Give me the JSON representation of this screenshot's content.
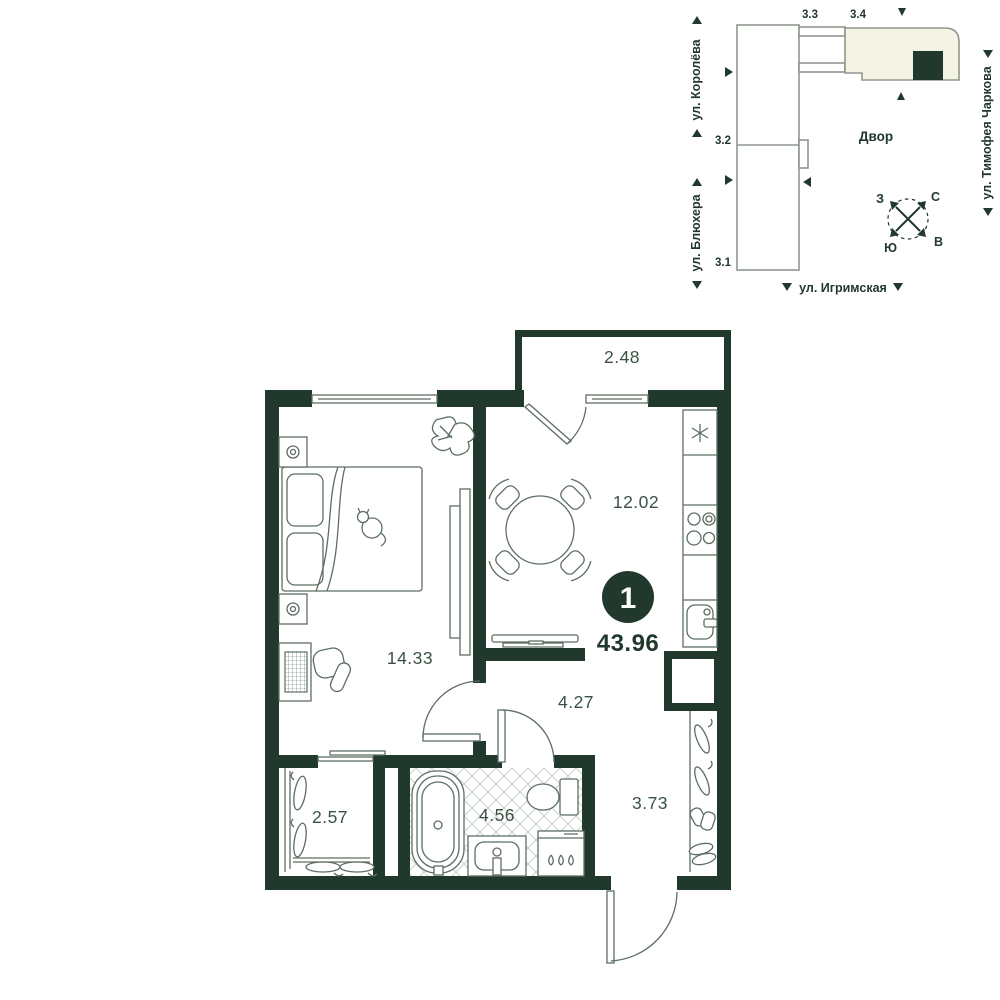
{
  "plan": {
    "apartment": {
      "rooms_count": "1",
      "total_area": "43.96",
      "areas": {
        "balcony": "2.48",
        "kitchen": "12.02",
        "living_room": "14.33",
        "hallway": "4.27",
        "wardrobe": "2.57",
        "bathroom": "4.56",
        "entry_hall": "3.73"
      }
    },
    "colors": {
      "wall": "#21382d",
      "furniture_line": "#5c6e62",
      "room_label": "#3a5244",
      "site_outline": "#8d978e",
      "highlight_fill": "#f5f4e4",
      "tile_line": "#c9d3ca"
    }
  },
  "site_plan": {
    "courtyard": "Двор",
    "streets": {
      "west": "ул. Королёва",
      "south_west": "ул. Блюхера",
      "east": "ул. Тимофея Чаркова",
      "south": "ул. Игримская"
    },
    "buildings": {
      "b1": "3.1",
      "b2": "3.2",
      "b3": "3.3",
      "b4": "3.4"
    },
    "compass": {
      "north": "С",
      "south": "Ю",
      "west": "З",
      "east": "В"
    }
  }
}
